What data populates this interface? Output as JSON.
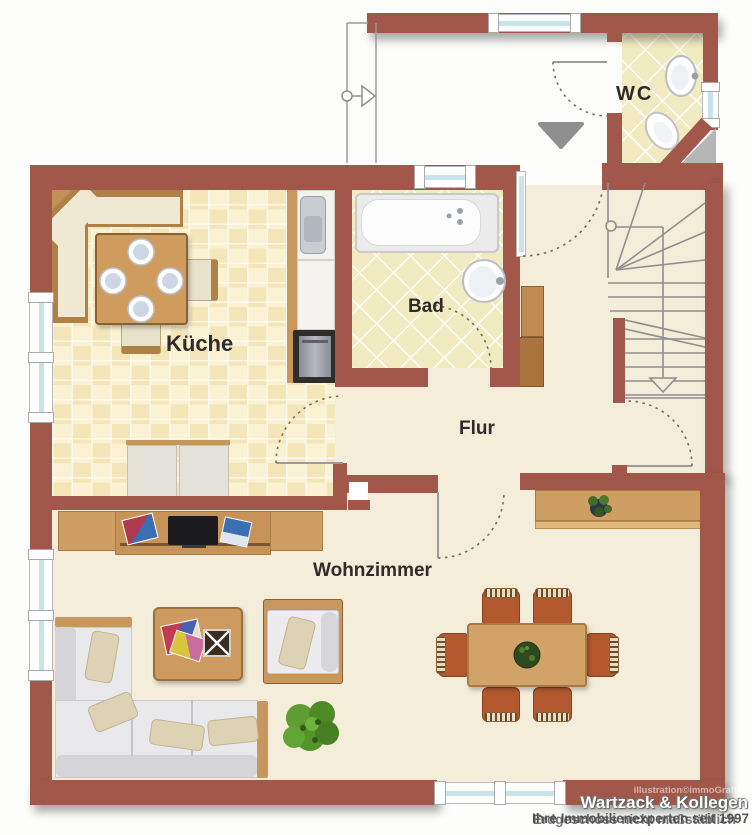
{
  "rooms": {
    "kueche": {
      "label": "Küche"
    },
    "bad": {
      "label": "Bad"
    },
    "wc": {
      "label": "WC"
    },
    "flur": {
      "label": "Flur"
    },
    "wohnzimmer": {
      "label": "Wohnzimmer"
    }
  },
  "watermark": {
    "credit": "illustration©immoGrafik",
    "company": "Wartzack & Kollegen",
    "tagline": "Ihre Immobilienexperten seit 1997",
    "note": "Erdgeschoss nicht maßstäblich"
  },
  "colors": {
    "wall": "#a1584a",
    "floor": "#f3edda",
    "tile_kitchen": "#f8edc8",
    "tile_bath": "#f2ebc2",
    "window_glass": "#c8e4ea",
    "wood": "#c89760",
    "accent_chair": "#b4592f"
  }
}
